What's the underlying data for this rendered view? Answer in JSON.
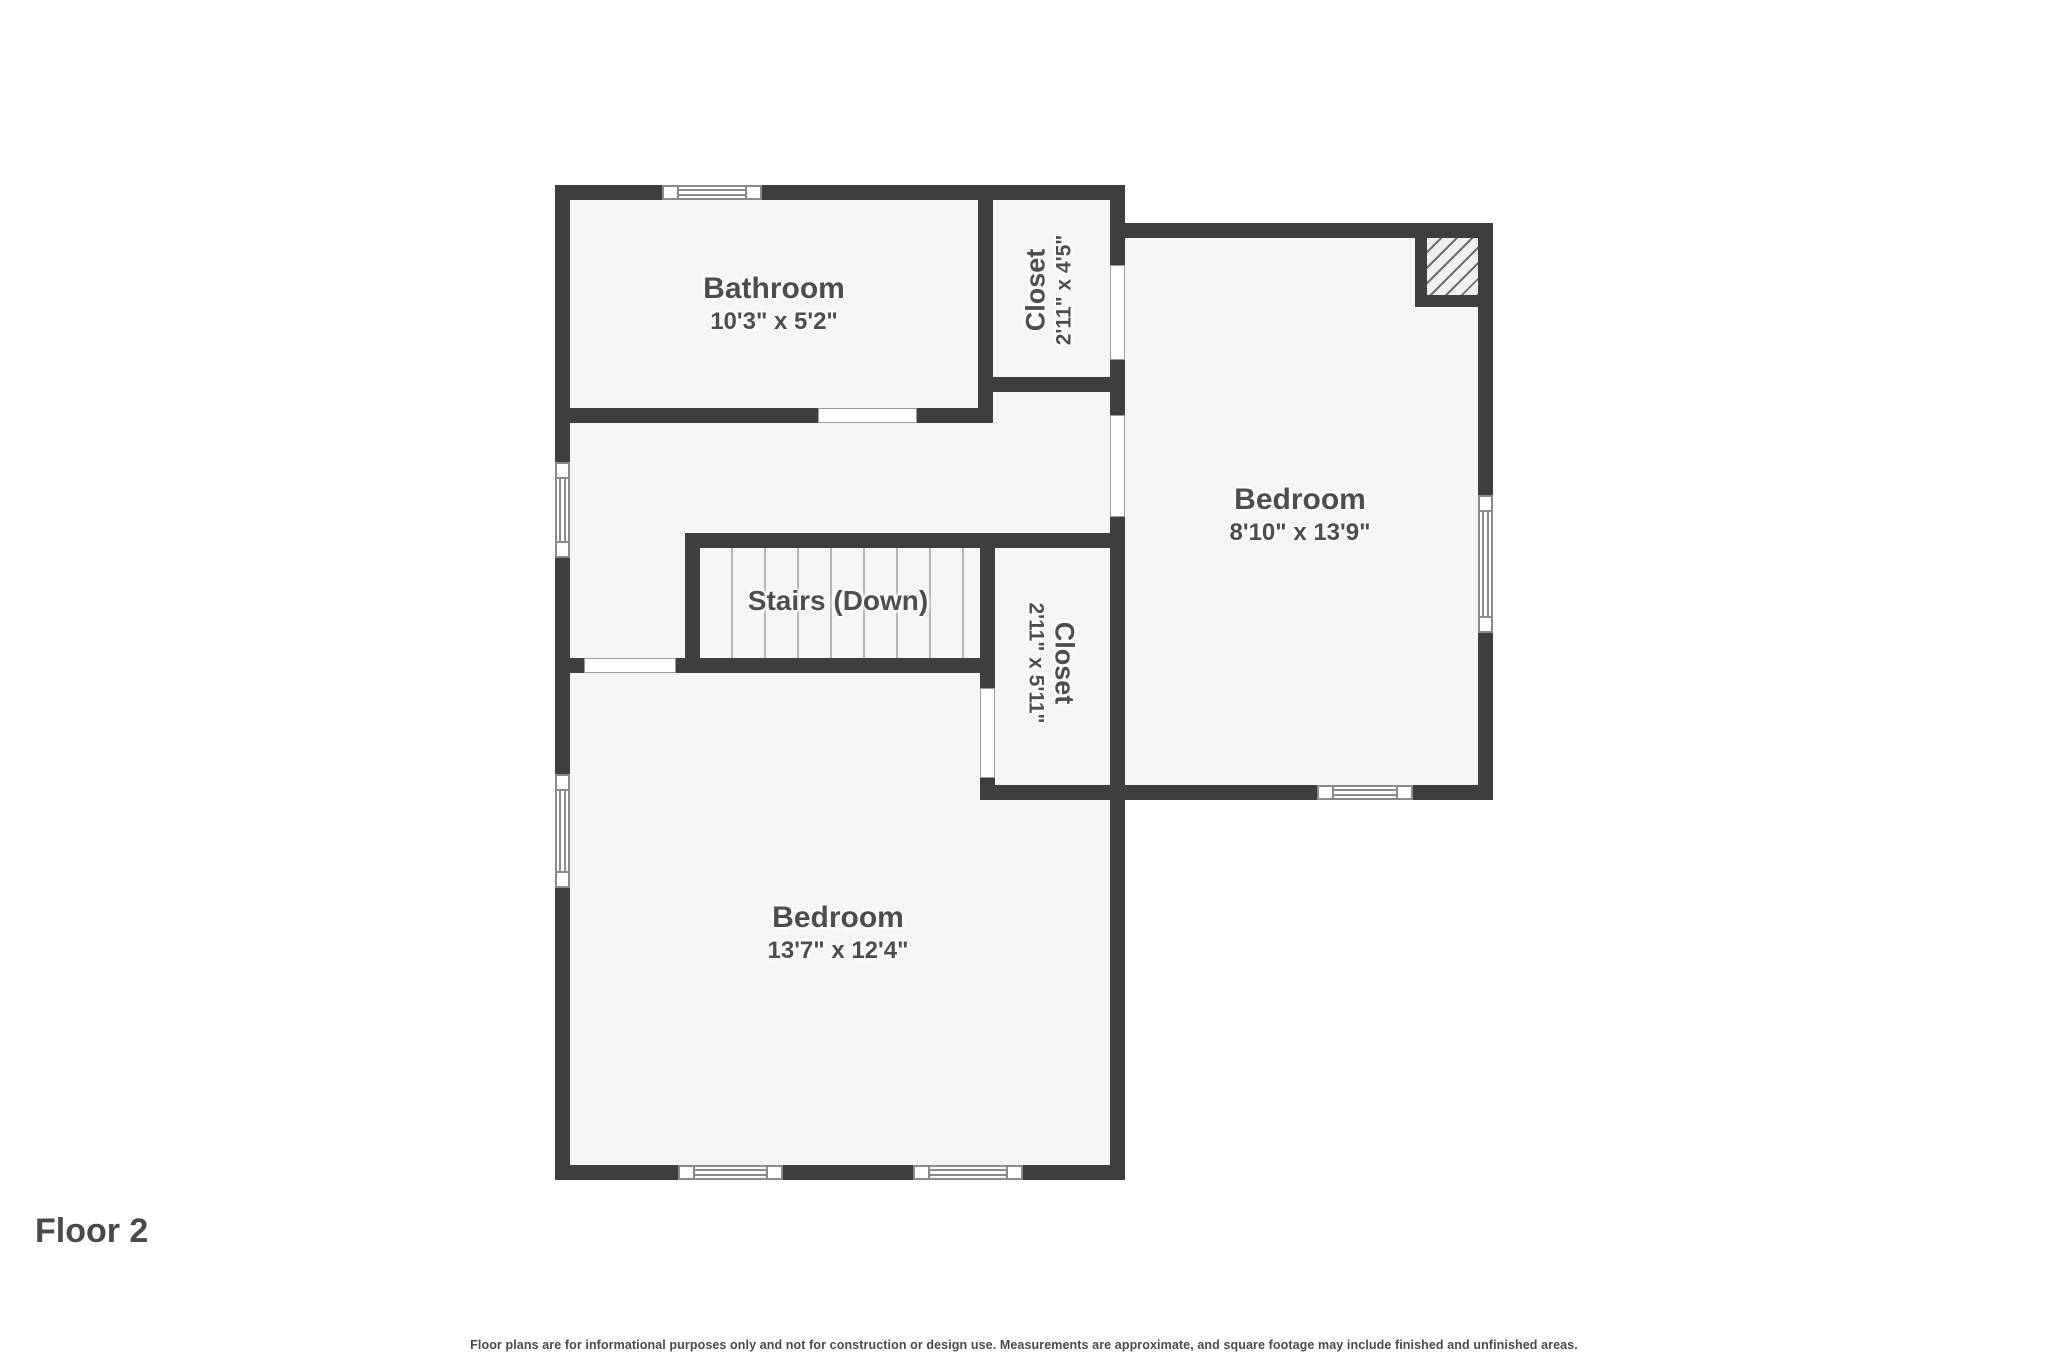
{
  "title": {
    "floor_label": "Floor 2"
  },
  "footer": {
    "disclaimer": "Floor plans are for informational purposes only and not for construction or design use. Measurements are approximate, and square footage may include finished and unfinished areas."
  },
  "rooms": {
    "bathroom": {
      "name": "Bathroom",
      "dims": "10'3\" x 5'2\""
    },
    "closet_top": {
      "name": "Closet",
      "dims": "2'11\" x 4'5\""
    },
    "bedroom_right": {
      "name": "Bedroom",
      "dims": "8'10\" x 13'9\""
    },
    "stairs": {
      "name": "Stairs (Down)"
    },
    "closet_bottom": {
      "name": "Closet",
      "dims": "2'11\" x 5'11\""
    },
    "bedroom_left": {
      "name": "Bedroom",
      "dims": "13'7\" x 12'4\""
    }
  },
  "colors": {
    "wall": "#3e3e3e",
    "room_fill": "#f5f5f5",
    "label_text": "#4d4d4d",
    "window_frame": "#8a8a8a",
    "page_background": "#ffffff"
  }
}
